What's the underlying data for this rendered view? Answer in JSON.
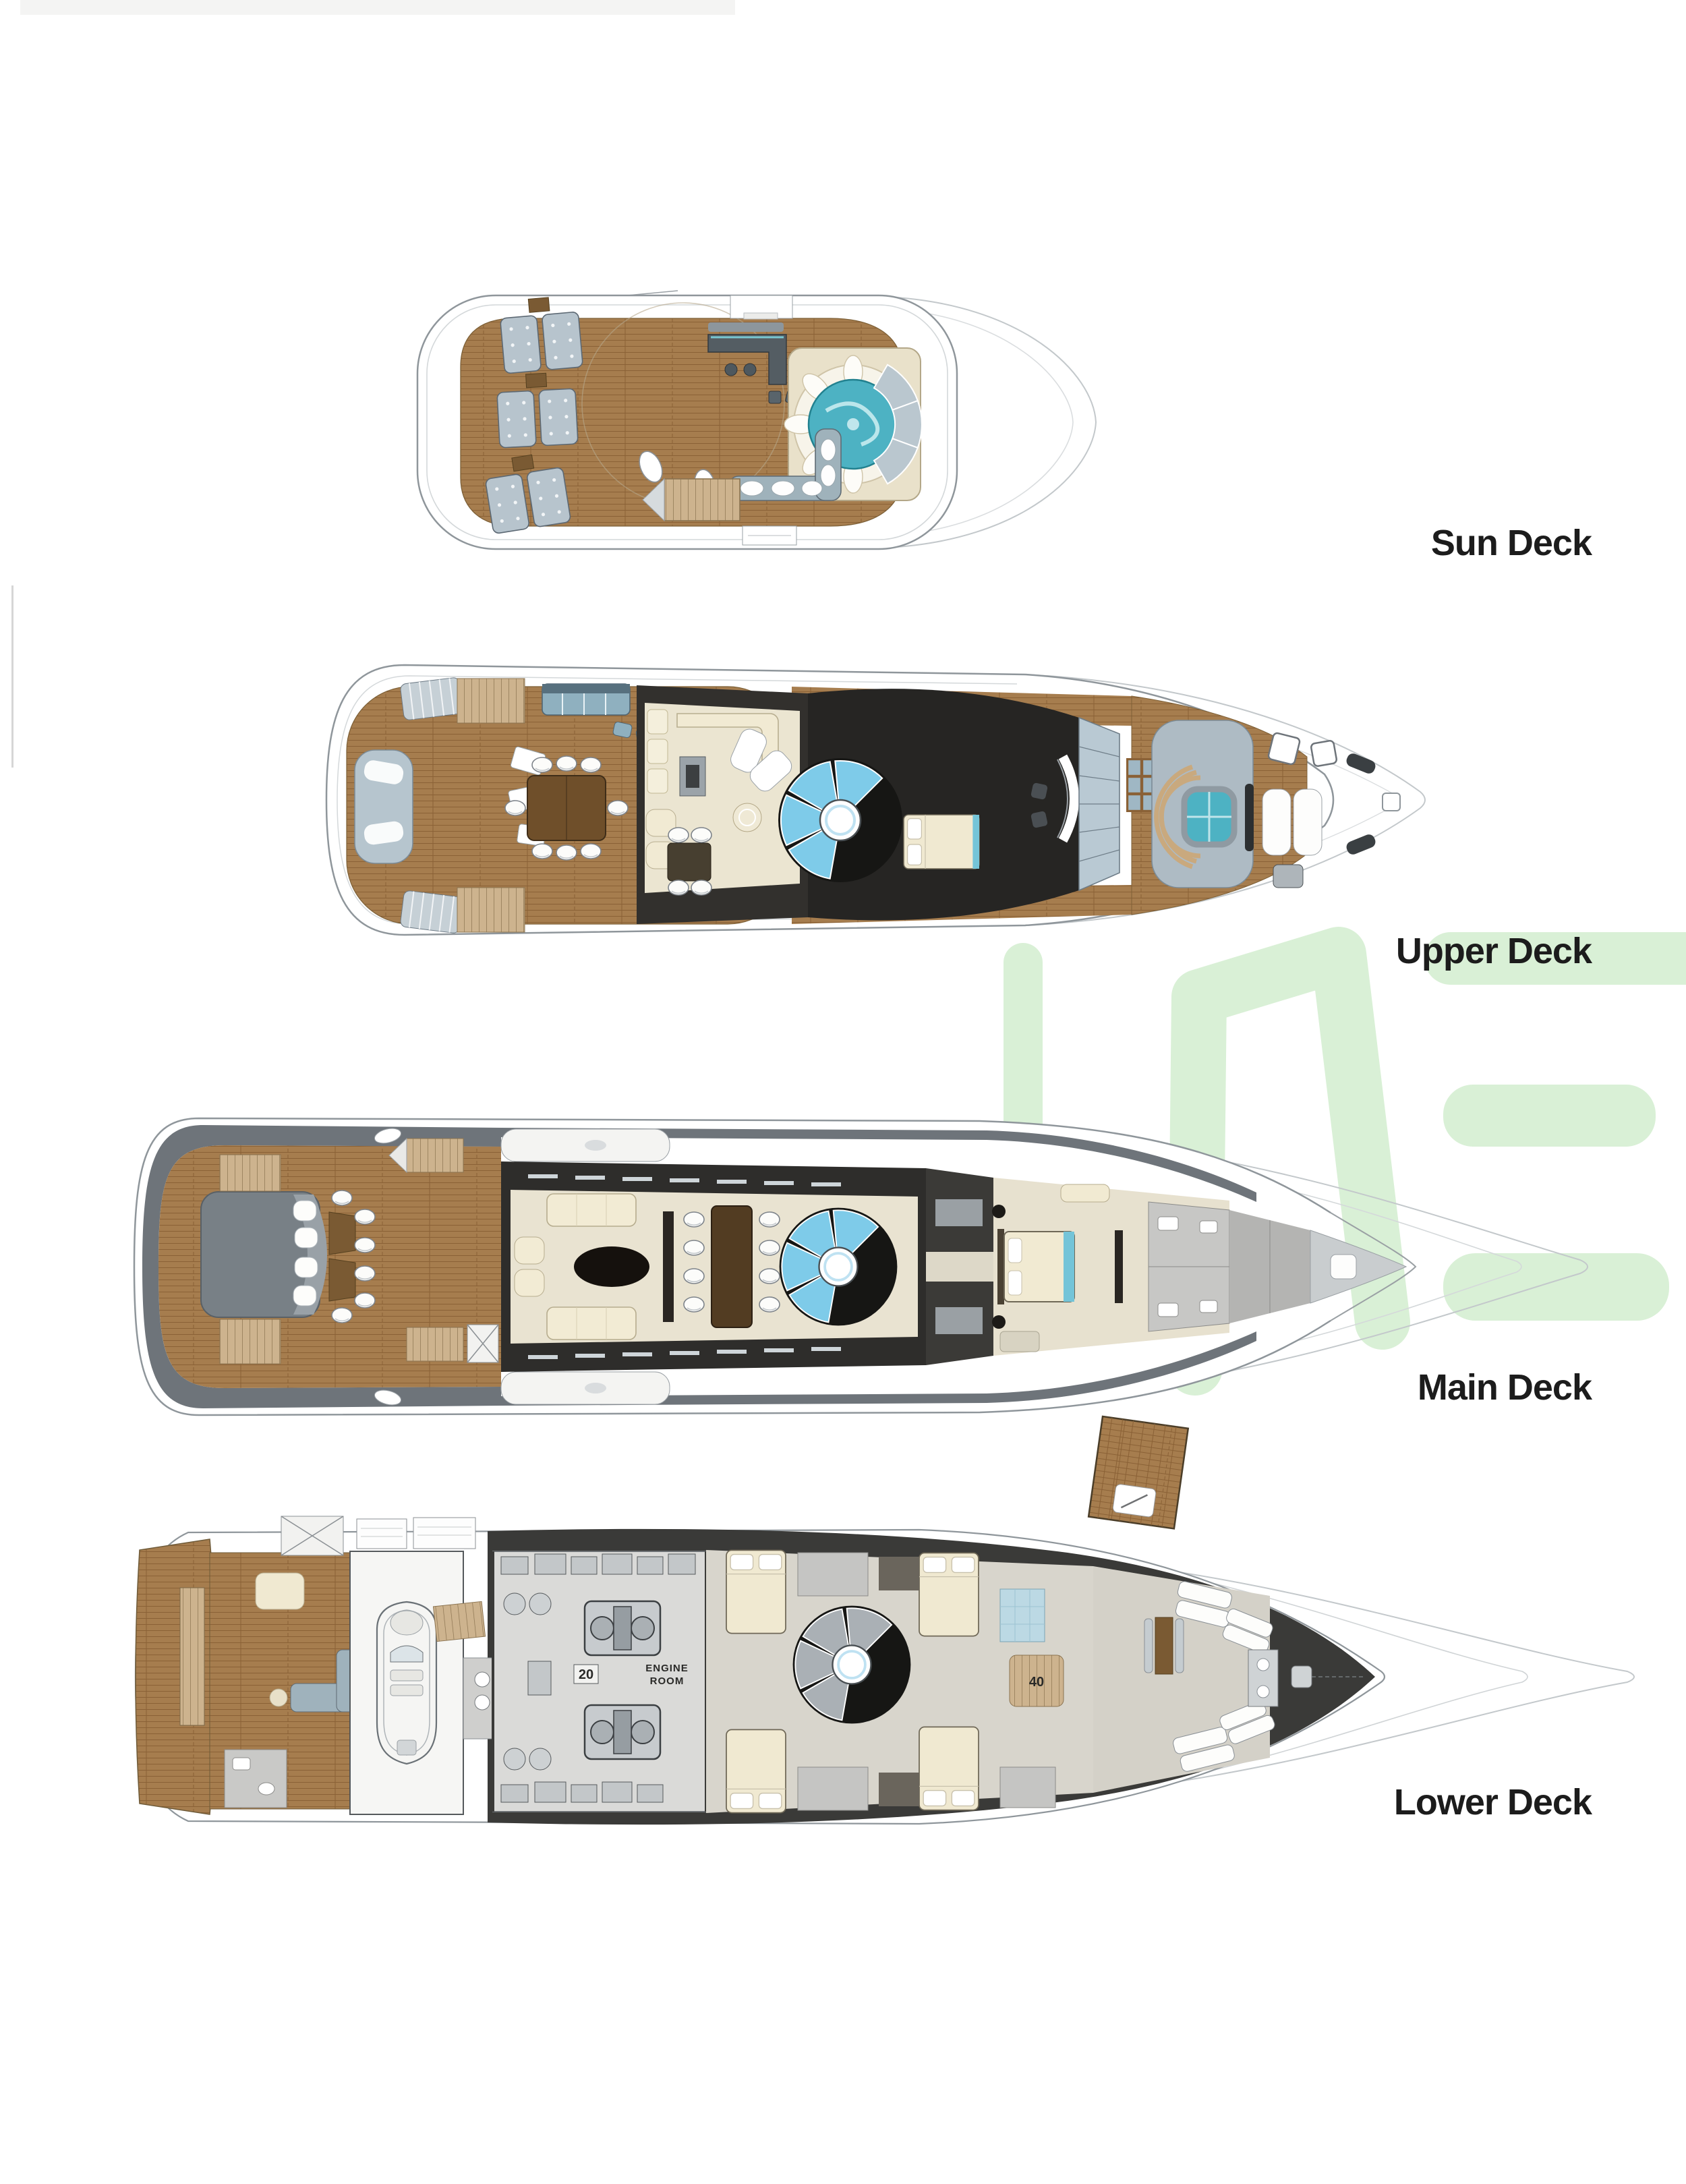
{
  "watermark": {
    "letters": "ME",
    "color": "#d9f0d6"
  },
  "decks": [
    {
      "id": "sun-deck",
      "label": "Sun Deck"
    },
    {
      "id": "upper-deck",
      "label": "Upper Deck"
    },
    {
      "id": "main-deck",
      "label": "Main Deck"
    },
    {
      "id": "lower-deck",
      "label": "Lower Deck"
    }
  ],
  "annotations": {
    "engine_room_line1": "ENGINE",
    "engine_room_line2": "ROOM",
    "engine_room_number": "20",
    "lower_stair_number": "40"
  },
  "palette": {
    "teak": "#a67d4e",
    "water_teal": "#4db2c3",
    "hull_outline": "#8f969b",
    "dark_interior": "#2e2d2b",
    "label_text": "#1c1c1c"
  }
}
